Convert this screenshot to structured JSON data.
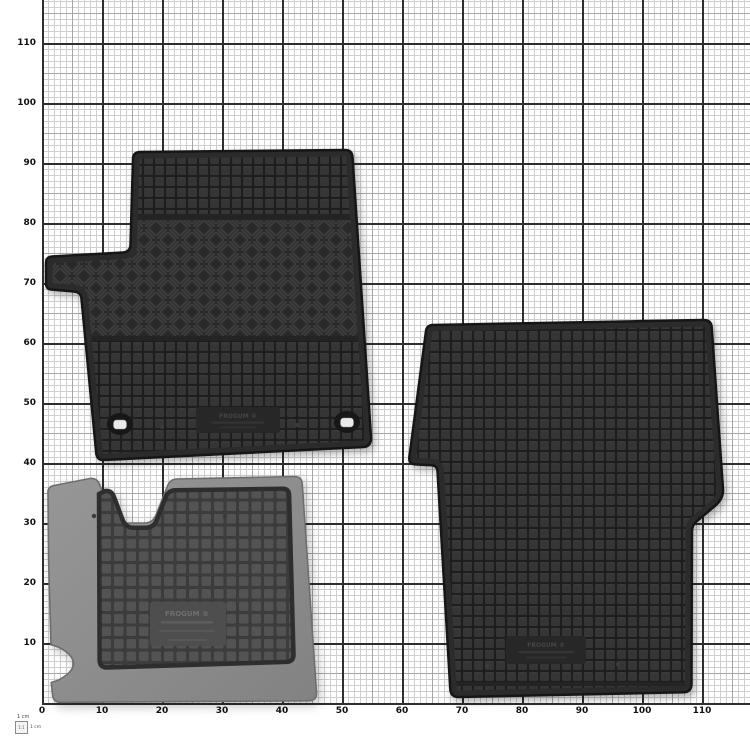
{
  "page": {
    "background": "#ffffff",
    "description_label": "rubber car floor mats on 1 cm measuring grid"
  },
  "grid": {
    "x_labels": [
      "0",
      "10",
      "20",
      "30",
      "40",
      "50",
      "60",
      "70",
      "80",
      "90",
      "100",
      "110"
    ],
    "y_labels": [
      "110",
      "100",
      "90",
      "80",
      "70",
      "60",
      "50",
      "40",
      "30",
      "20",
      "10"
    ],
    "px_per_cm": 6,
    "major_every_cm": 10,
    "medium_every_cm": 5,
    "colors": {
      "paper": "#ffffff",
      "fine": "#cfcfcf",
      "medium": "#a6a6a6",
      "major": "#2e2e2e",
      "label": "#111111"
    }
  },
  "legend": {
    "title": "1 cm",
    "scale": "1:1",
    "unit": "1 cm"
  },
  "mats": {
    "front": {
      "brand": "FROGUM ®",
      "base_color": "#2a2a2a",
      "square_color": "#363636"
    },
    "rear": {
      "brand": "FROGUM ®",
      "base_color": "#2a2a2a",
      "square_color": "#363636"
    },
    "underside": {
      "brand": "FROGUM ®",
      "base_color": "#8c8c8c",
      "panel_color": "#4c4c4c"
    }
  }
}
